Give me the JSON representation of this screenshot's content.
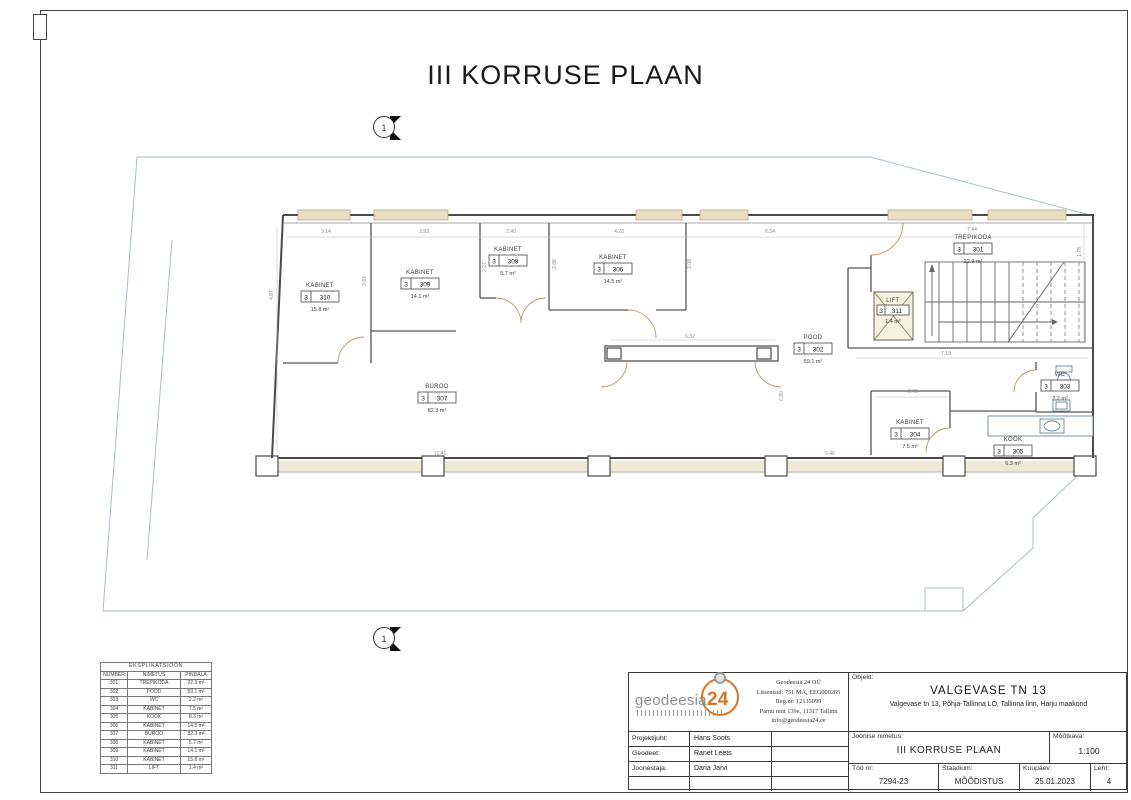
{
  "sheet": {
    "title": "III KORRUSE PLAAN",
    "section_marker": "1"
  },
  "plan": {
    "rooms": [
      {
        "label": "TREPIKODA",
        "floor": "3",
        "num": "301",
        "area": "22.9 m²"
      },
      {
        "label": "POOD",
        "floor": "3",
        "num": "302",
        "area": "59.1 m²"
      },
      {
        "label": "WC",
        "floor": "3",
        "num": "303",
        "area": "2.2 m²"
      },
      {
        "label": "KABINET",
        "floor": "3",
        "num": "304",
        "area": "7.5 m²"
      },
      {
        "label": "KÖÖK",
        "floor": "3",
        "num": "305",
        "area": "6.3 m²"
      },
      {
        "label": "KABINET",
        "floor": "3",
        "num": "306",
        "area": "14.5 m²"
      },
      {
        "label": "BÜROO",
        "floor": "3",
        "num": "307",
        "area": "82.3 m²"
      },
      {
        "label": "KABINET",
        "floor": "3",
        "num": "308",
        "area": "5.7 m²"
      },
      {
        "label": "KABINET",
        "floor": "3",
        "num": "309",
        "area": "14.1 m²"
      },
      {
        "label": "KABINET",
        "floor": "3",
        "num": "310",
        "area": "15.8 m²"
      },
      {
        "label": "LIFT",
        "floor": "3",
        "num": "311",
        "area": "1.4 m²"
      }
    ],
    "dims": [
      "3.14",
      "3.93",
      "2.40",
      "4.28",
      "6.34",
      "7.44",
      "4.87",
      "3.87",
      "2.27",
      "2.88",
      "3.08",
      "1.78",
      "12.41",
      "6.32",
      "6.80",
      "7.19",
      "2.72",
      "6.46",
      "4.29"
    ]
  },
  "explication": {
    "title": "EKSPLIKATSIOON",
    "columns": [
      "NUMBER",
      "NIMETUS",
      "PINDALA"
    ],
    "rows": [
      [
        "301",
        "TREPIKODA",
        "22.9 m²"
      ],
      [
        "302",
        "POOD",
        "59.1 m²"
      ],
      [
        "303",
        "WC",
        "2.2 m²"
      ],
      [
        "304",
        "KABINET",
        "7.5 m²"
      ],
      [
        "305",
        "KÖÖK",
        "8.3 m²"
      ],
      [
        "306",
        "KABINET",
        "14.5 m²"
      ],
      [
        "307",
        "BÜROO",
        "82.3 m²"
      ],
      [
        "308",
        "KABINET",
        "5.7 m²"
      ],
      [
        "309",
        "KABINET",
        "14.1 m²"
      ],
      [
        "310",
        "KABINET",
        "15.8 m²"
      ],
      [
        "311",
        "LIFT",
        "1.4 m²"
      ]
    ]
  },
  "title_block": {
    "logo": {
      "gray": "geodeesia",
      "orange": "24"
    },
    "company": {
      "name": "Geodeesia 24 OÜ",
      "line2": "Litsentsid: 751 MA, EEG000265",
      "line3": "Reg.nr: 12135099",
      "line4": "Pärnu mnt 139e, 11317 Tallinn",
      "line5": "info@geodeesia24.ee"
    },
    "objekt_label": "Objekt:",
    "objekt_name": "VALGEVASE TN 13",
    "objekt_address": "Valgevase tn 13, Põhja-Tallinna LO, Tallinna linn, Harju maakond",
    "projektijuht_label": "Projektijuht:",
    "projektijuht": "Hans Soots",
    "geodeet_label": "Geodeet:",
    "geodeet": "Ranet Leets",
    "joonestaja_label": "Joonestaja:",
    "joonestaja": "Daria Jarvi",
    "joonise_label": "Joonise nimetus:",
    "joonise_name": "III KORRUSE PLAAN",
    "mootkava_label": "Mõõtkava:",
    "mootkava": "1:100",
    "too_label": "Töö nr:",
    "too": "7294-23",
    "staadium_label": "Staadium:",
    "staadium": "MÕÕDISTUS",
    "kuupaev_label": "Kuupäev:",
    "kuupaev": "25.01.2023",
    "leht_label": "Leht:",
    "leht": "4"
  },
  "colors": {
    "accent_orange": "#d4762a",
    "wall": "#4a4a4a",
    "boundary": "#a9bfc9",
    "beige": "#e8dfc6"
  }
}
